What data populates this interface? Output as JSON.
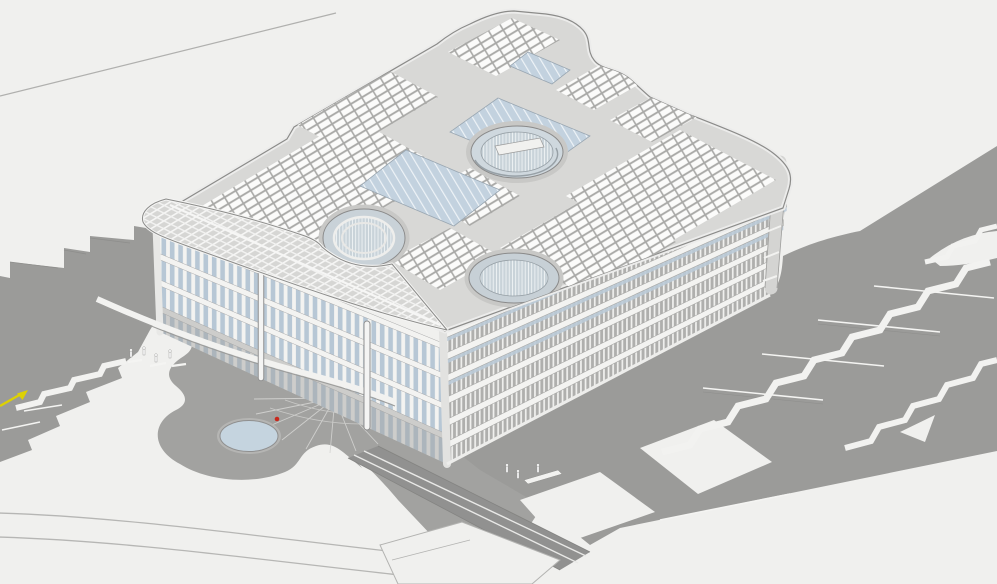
{
  "scene": {
    "kind": "aerial-axonometric-architectural-model",
    "subject": "large low-rise office building with rooftop solar arrays, skylights and circular courtyards, set in a terraced gray landscape with stairs, paths and two ponds",
    "visible_text": []
  },
  "colors": {
    "background": "#f0f0ee",
    "terrain": "#9b9b99",
    "terrain_dark": "#8f8f8d",
    "apron": "#a2a2a0",
    "ramp": "#919190",
    "white_path": "#f2f2f0",
    "edge_dark": "#8b8b89",
    "edge_light": "#ececeb",
    "roof": "#d8d8d6",
    "roof_band": "#c9c9c7",
    "panel_field": "#a9a9a7",
    "panel_cell": "#fbfbfa",
    "skylight_blue": "#c3d2df",
    "glass_blue": "#b7c7d5",
    "court_glass": "#c9d3d9",
    "facade_fins": "#afafad",
    "slab_white": "#f3f3f1",
    "canopy": "#d6d6d4",
    "pond": "#c5d4df",
    "pond_rim": "#8f8f8f",
    "arrow_yellow": "#ddd103",
    "marker_red": "#c8281c",
    "figure": "#ffffff",
    "line_gray": "#b0b0ae"
  },
  "annotations": {
    "direction_arrow": {
      "name": "yellow-direction-arrow",
      "x": 14,
      "y": 398
    },
    "point_marker": {
      "name": "red-point-marker",
      "x": 277,
      "y": 419
    }
  },
  "building": {
    "rooftop": [
      "solar-panel-arrays",
      "blue-skylight-strips",
      "central-oculus",
      "west-oculus",
      "south-oculus",
      "rounded-parapet"
    ],
    "facades": [
      "west-facade-vertical-glazing",
      "southeast-facade-terraced-floors-with-fins"
    ],
    "entry": [
      "triangular-lattice-canopy",
      "two-slender-columns",
      "radial-paving-fan"
    ]
  },
  "landscape": {
    "ponds": 2,
    "stair_zigzags": 4,
    "terrace_lines": 4,
    "people_groups": 2,
    "curved_footpaths": 2
  }
}
